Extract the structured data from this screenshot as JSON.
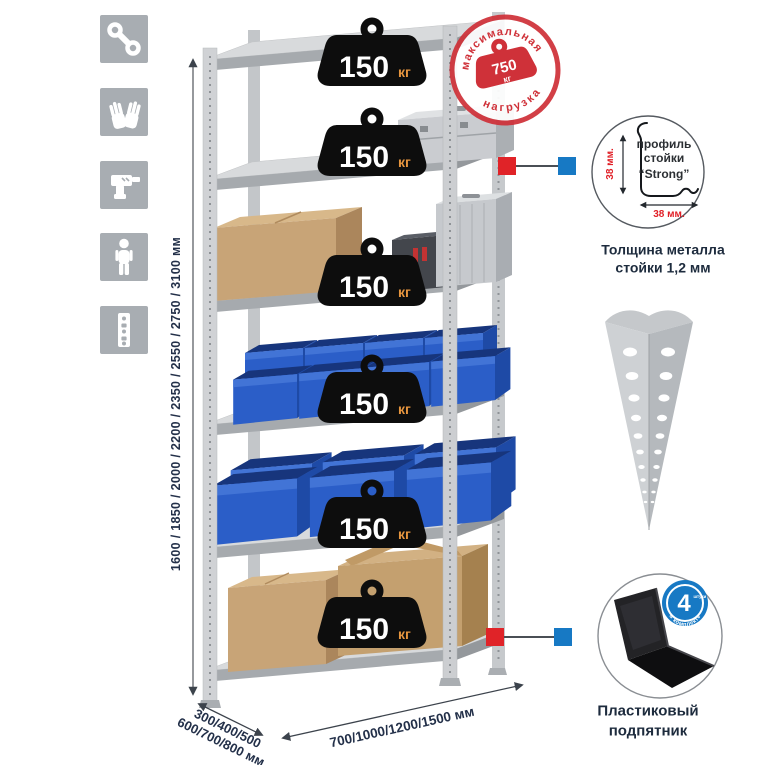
{
  "colors": {
    "accent_red": "#cf3139",
    "bright_red": "#e02328",
    "accent_blue": "#1779c4",
    "bin_blue": "#2b5ec8",
    "cardboard": "#c8a477",
    "metal_gray": "#d0d2d5",
    "icon_gray": "#a8adb2",
    "navy_text": "#233049",
    "weight_black": "#0d0d0d",
    "unit_orange": "#e6953e"
  },
  "left_icons": {
    "items": [
      {
        "name": "wrench-icon"
      },
      {
        "name": "gloves-icon"
      },
      {
        "name": "drill-icon"
      },
      {
        "name": "person-icon"
      },
      {
        "name": "upright-profile-icon"
      }
    ]
  },
  "shelf_loads": [
    {
      "value": "150",
      "unit": "кг"
    },
    {
      "value": "150",
      "unit": "кг"
    },
    {
      "value": "150",
      "unit": "кг"
    },
    {
      "value": "150",
      "unit": "кг"
    },
    {
      "value": "150",
      "unit": "кг"
    },
    {
      "value": "150",
      "unit": "кг"
    }
  ],
  "max_load_stamp": {
    "arc_top": "максимальная",
    "arc_bottom": "нагрузка",
    "value": "750",
    "unit": "кг"
  },
  "profile_detail": {
    "line1": "профиль",
    "line2": "стойки",
    "line3": "“Strong”",
    "dim_vertical": "38 мм.",
    "dim_horizontal": "38 мм.",
    "caption_line1": "Толщина металла",
    "caption_line2": "стойки 1,2 мм"
  },
  "foot_detail": {
    "badge_value": "4",
    "badge_word": "штуки",
    "badge_arc": "в комплекте",
    "caption_line1": "Пластиковый",
    "caption_line2": "подпятник"
  },
  "dimensions": {
    "height": "1600 / 1850 / 2000 / 2200 / 2350 / 2550 / 2750 / 3100 мм",
    "depth_line1": "300/400/500",
    "depth_line2": "600/700/800 мм",
    "width": "700/1000/1200/1500 мм"
  }
}
